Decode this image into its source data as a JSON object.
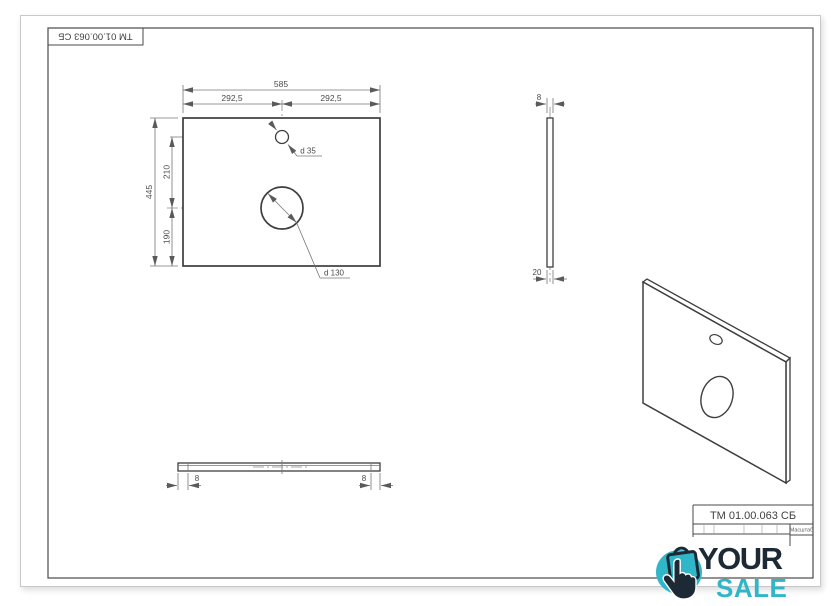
{
  "stamp_top_left": {
    "designation": "TM 01.00.063 СБ"
  },
  "title_block": {
    "designation": "TM 01.00.063 СБ",
    "scale_label": "Масштаб"
  },
  "front_view": {
    "dim_total_width": "585",
    "dim_half_left": "292,5",
    "dim_half_right": "292,5",
    "dim_total_height": "445",
    "dim_hole_distance": "210",
    "dim_bottom_offset": "190",
    "label_small_hole": "d 35",
    "label_large_hole": "d 130"
  },
  "side_view": {
    "dim_thickness": "8",
    "dim_depth": "20"
  },
  "bottom_view": {
    "dim_left_thickness": "8",
    "dim_right_thickness": "8"
  },
  "watermark": {
    "word_top": "YOUR",
    "word_bottom": "SALE",
    "color_accent": "#2fb6c9",
    "color_dark": "#1d2935"
  }
}
